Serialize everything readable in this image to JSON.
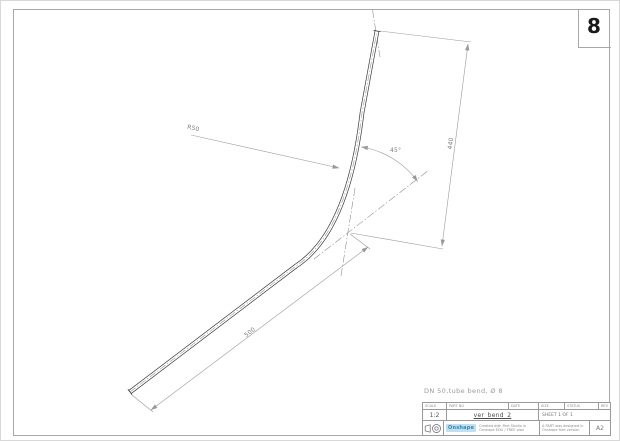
{
  "sheet": {
    "number": "8",
    "paper_size": "A2"
  },
  "note_above_titleblock": "DN 50,tube bend,    Ø 8",
  "dimensions": {
    "radius": "R50",
    "angle": "45°",
    "length_vertical": "440",
    "length_bottom": "500"
  },
  "title_block": {
    "headers": {
      "scale": "SCALE",
      "name": "PART NO",
      "date": "DATE",
      "size": "SIZE",
      "status": "STATUS",
      "rev": "REV"
    },
    "scale_value": "1:2",
    "part_name": "ver_bend_2",
    "sheet_value": "SHEET 1 OF 1",
    "logo": "Onshape",
    "tagline_line1": "Created with Part Studio in",
    "tagline_line2": "Onshape EDU / FREE plan",
    "copyright_line1": "A PART was designed in",
    "copyright_line2": "Onshape free version",
    "paper_size": "A2"
  },
  "colors": {
    "tube_line": "#3a3a3a",
    "dimension_line": "#9a9a9a",
    "logo_accent": "#2f86b8"
  }
}
